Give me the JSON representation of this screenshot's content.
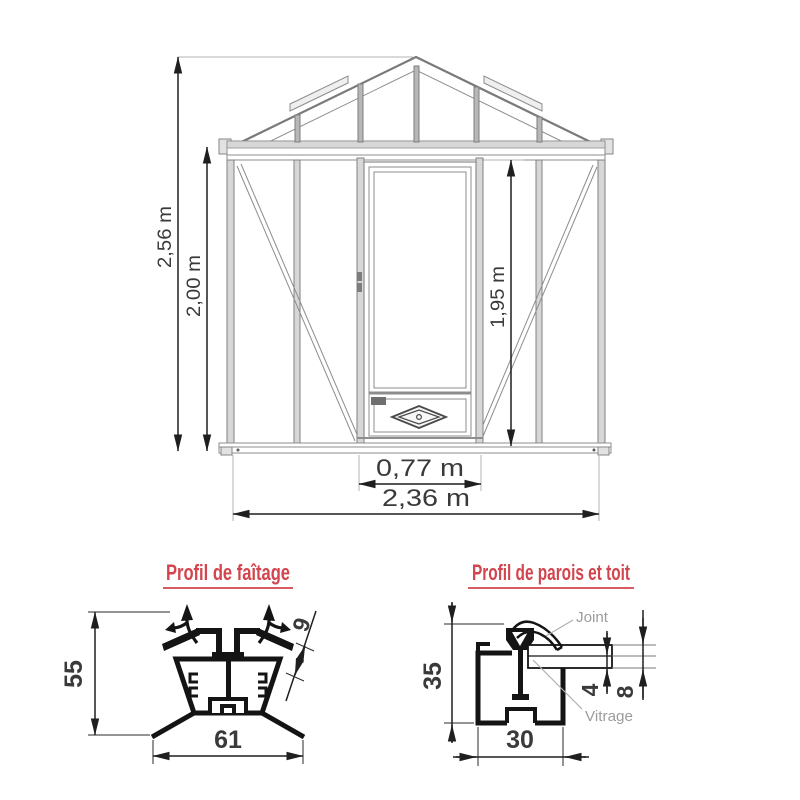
{
  "elevation": {
    "dims": {
      "total_height": "2,56 m",
      "wall_height": "2,00 m",
      "door_height": "1,95 m",
      "door_width": "0,77 m",
      "total_width": "2,36 m"
    }
  },
  "ridge_profile": {
    "title": "Profil de faîtage",
    "dims": {
      "height": "55",
      "width": "61",
      "thickness": "9"
    }
  },
  "wall_roof_profile": {
    "title": "Profil de parois et toit",
    "dims": {
      "height": "35",
      "width": "30",
      "glass_single": "4",
      "glass_double": "8"
    },
    "labels": {
      "joint": "Joint",
      "glazing": "Vitrage"
    }
  },
  "colors": {
    "accent_red": "#d2454e",
    "dimension_dark": "#1f1f1f",
    "structure_gray": "#8d8d8d",
    "muted_gray": "#9c9c9c"
  }
}
